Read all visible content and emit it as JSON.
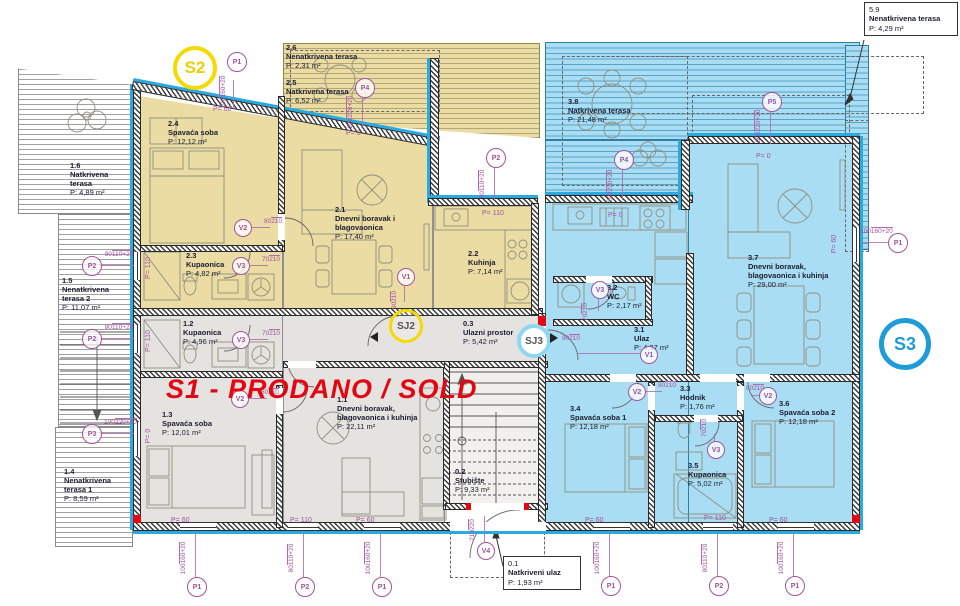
{
  "badges": {
    "s1_sold": "S1 - PRODANO / SOLD",
    "s2": "S2",
    "s3": "S3",
    "sj2": "SJ2",
    "sj3": "SJ3"
  },
  "colors": {
    "accent_cyan": "#29abe2",
    "unit_s1_gray": "#e4e3e0",
    "unit_s2_yellow": "#eadca2",
    "unit_s3_blue": "#a9ddf3",
    "marker_purple": "#a3539f",
    "sold_red": "#e30613",
    "s2_badge_yellow": "#f4da00",
    "s3_badge_blue": "#1e9cd7"
  },
  "rooms": [
    {
      "num": "1.6",
      "name": "Natkrivena terasa",
      "area": "P: 4,89 m²"
    },
    {
      "num": "1.5",
      "name": "Nenatkrivena terasa 2",
      "area": "P: 11,07 m²"
    },
    {
      "num": "1.4",
      "name": "Nenatkrivena terasa 1",
      "area": "P: 8,59 m²"
    },
    {
      "num": "2.6",
      "name": "Nenatkrivena terasa",
      "area": "P: 2,31 m²"
    },
    {
      "num": "2.5",
      "name": "Natkrivena terasa",
      "area": "P: 6,52 m²"
    },
    {
      "num": "2.4",
      "name": "Spavaća soba",
      "area": "P: 12,12 m²"
    },
    {
      "num": "2.1",
      "name": "Dnevni boravak i blagovaonica",
      "area": "P: 17,40 m²"
    },
    {
      "num": "2.3",
      "name": "Kupaonica",
      "area": "P: 4,82 m²"
    },
    {
      "num": "2.2",
      "name": "Kuhinja",
      "area": "P: 7,14 m²"
    },
    {
      "num": "1.2",
      "name": "Kupaonica",
      "area": "P: 4,96 m²"
    },
    {
      "num": "1.3",
      "name": "Spavaća soba",
      "area": "P: 12,01 m²"
    },
    {
      "num": "1.1",
      "name": "Dnevni boravak, blagovaonica i kuhinja",
      "area": "P: 22,11 m²"
    },
    {
      "num": "0.3",
      "name": "Ulazni prostor",
      "area": "P: 5,42 m²"
    },
    {
      "num": "0.2",
      "name": "Stubište",
      "area": "P: 9,33 m²"
    },
    {
      "num": "0.1",
      "name": "Natkriveni ulaz",
      "area": "P: 1,93 m²"
    },
    {
      "num": "3.8",
      "name": "Natkrivena terasa",
      "area": "P: 21,48 m²"
    },
    {
      "num": "3.7",
      "name": "Dnevni boravak, blagovaonica i kuhinja",
      "area": "P: 29,00 m²"
    },
    {
      "num": "3.2",
      "name": "WC",
      "area": "P: 2,17 m²"
    },
    {
      "num": "3.1",
      "name": "Ulaz",
      "area": "P: 4,37 m²"
    },
    {
      "num": "3.3",
      "name": "Hodnik",
      "area": "P: 1,76 m²"
    },
    {
      "num": "3.4",
      "name": "Spavaća soba 1",
      "area": "P: 12,18 m²"
    },
    {
      "num": "3.5",
      "name": "Kupaonica",
      "area": "P: 5,02 m²"
    },
    {
      "num": "3.6",
      "name": "Spavaća soba 2",
      "area": "P: 12,18 m²"
    },
    {
      "num": "5.9",
      "name": "Nenatkrivena terasa",
      "area": "P: 4,29 m²"
    }
  ],
  "markers": [
    {
      "label": "P1",
      "d1": "100",
      "d2": "160+20",
      "sill": "P= 60"
    },
    {
      "label": "P4",
      "d1": "200",
      "d2": "220+20",
      "sill": "P= 0"
    },
    {
      "label": "P2",
      "d1": "80",
      "d2": "110+20",
      "sill": "P= 110"
    },
    {
      "label": "P4",
      "d1": "200",
      "d2": "220+20",
      "sill": "P= 0"
    },
    {
      "label": "P5",
      "d1": "300",
      "d2": "220+20",
      "sill": "P= 0"
    },
    {
      "label": "P1",
      "d1": "100",
      "d2": "160+20",
      "sill": "P= 60"
    },
    {
      "label": "P2",
      "d1": "80",
      "d2": "110+20",
      "sill": "P= 110"
    },
    {
      "label": "P2",
      "d1": "80",
      "d2": "110+20",
      "sill": "P= 110"
    },
    {
      "label": "P3",
      "d1": "100",
      "d2": "220+20",
      "sill": "P= 0"
    },
    {
      "label": "P1",
      "d1": "100",
      "d2": "160+20",
      "sill": "P= 60"
    },
    {
      "label": "P2",
      "d1": "80",
      "d2": "110+20",
      "sill": "P= 110"
    },
    {
      "label": "P1",
      "d1": "100",
      "d2": "160+20",
      "sill": "P= 60"
    },
    {
      "label": "P1",
      "d1": "100",
      "d2": "160+20",
      "sill": "P= 60"
    },
    {
      "label": "P2",
      "d1": "80",
      "d2": "110+20",
      "sill": "P= 110"
    },
    {
      "label": "P1",
      "d1": "100",
      "d2": "160+20",
      "sill": "P= 60"
    },
    {
      "label": "V4",
      "d1": "210",
      "d2": "220",
      "sill": ""
    },
    {
      "label": "V1",
      "d1": "90",
      "d2": "210",
      "sill": ""
    },
    {
      "label": "V2",
      "d1": "80",
      "d2": "210",
      "sill": ""
    },
    {
      "label": "V3",
      "d1": "70",
      "d2": "210",
      "sill": ""
    },
    {
      "label": "V3",
      "d1": "70",
      "d2": "210",
      "sill": ""
    },
    {
      "label": "V2",
      "d1": "80",
      "d2": "210",
      "sill": ""
    },
    {
      "label": "V1",
      "d1": "90",
      "d2": "210",
      "sill": ""
    },
    {
      "label": "V3",
      "d1": "70",
      "d2": "210",
      "sill": ""
    },
    {
      "label": "V2",
      "d1": "80",
      "d2": "210",
      "sill": ""
    },
    {
      "label": "V2",
      "d1": "80",
      "d2": "210",
      "sill": ""
    },
    {
      "label": "V3",
      "d1": "70",
      "d2": "210",
      "sill": ""
    }
  ]
}
